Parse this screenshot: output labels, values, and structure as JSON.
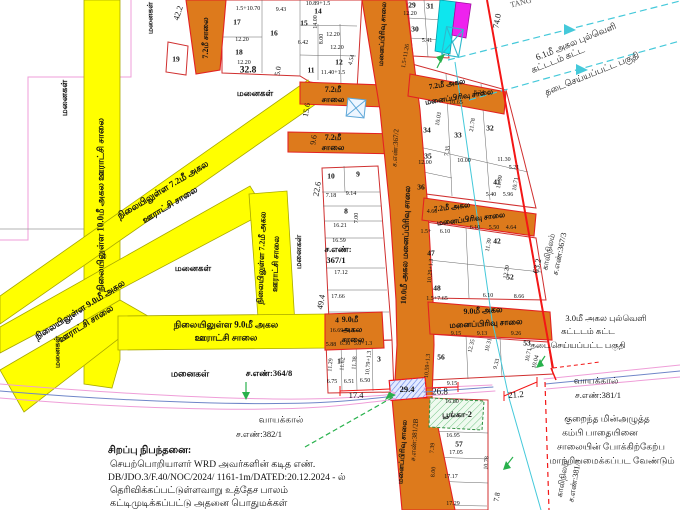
{
  "special_note": {
    "heading": "சிறப்பு நிபந்தனை:",
    "lines": [
      "செயற்பொறியாளர் WRD அவர்களின் கடித எண்.",
      "DB/JDO.3/F.40/NOC/2024/ 1161-1m/DATED:20.12.2024 - ல்",
      "தெரிவிக்கப்பட்டுள்ளவாறு உத்தேச பாலம்",
      "கட்டிமுடிக்கப்பட்டு அதனை பொதுமக்கள்"
    ]
  },
  "colors": {
    "road_yellow": "#ffff00",
    "road_orange": "#dd7a1c",
    "boundary_red": "#f31616",
    "parcel_pink": "#ef9ed8",
    "stream_blue": "#6f86c8",
    "powerline_cyan": "#45c9da",
    "marker_green": "#28b14c",
    "park_green": "#3fae5a",
    "block_magenta": "#ee22ee",
    "block_cyan": "#0ee6ee"
  },
  "map": {
    "road_labels": [
      {
        "t": "நிலையிலுள்ள 10.0மீ அகல ஊராட்சி சாலை",
        "x": 101,
        "y": 205,
        "r": -90,
        "s": 9
      },
      {
        "t": "நிலையிலுள்ள 7.2மீ அகல",
        "x": 262,
        "y": 258,
        "r": -88
      },
      {
        "t": "ஊராட்சி சாலை",
        "x": 276,
        "y": 264,
        "r": -88
      },
      {
        "t": "நிலையிலுள்ள 7.2மீ அகல",
        "x": 163,
        "y": 190,
        "r": -31,
        "s": 9
      },
      {
        "t": "ஊராட்சி சாலை",
        "x": 170,
        "y": 205,
        "r": -31,
        "s": 9
      },
      {
        "t": "நிலையிலுள்ள 9.0மீ அகல",
        "x": 80,
        "y": 310,
        "r": -32,
        "s": 9
      },
      {
        "t": "ஊராட்சி சாலை",
        "x": 86,
        "y": 324,
        "r": -32,
        "s": 9
      },
      {
        "t": "நிலையிலுள்ள 9.0மீ அகல",
        "x": 226,
        "y": 325,
        "s": 9
      },
      {
        "t": "ஊராட்சி சாலை",
        "x": 226,
        "y": 338,
        "s": 9
      },
      {
        "t": "7.2மீ சாலை",
        "x": 206,
        "y": 38,
        "r": -90
      },
      {
        "t": "7.2மீ",
        "x": 333,
        "y": 90
      },
      {
        "t": "சாலை",
        "x": 333,
        "y": 100
      },
      {
        "t": "7.2மீ",
        "x": 333,
        "y": 138
      },
      {
        "t": "சாலை",
        "x": 333,
        "y": 148
      },
      {
        "t": "மனைப்பிரிவு சாலை",
        "x": 383,
        "y": 34,
        "r": -87,
        "s": 7
      },
      {
        "t": "ச.எண்:367/2",
        "x": 396,
        "y": 148,
        "r": -87,
        "s": 7,
        "w": 400
      },
      {
        "t": "10.0மீ அகல மனைப்பிரிவு சாலை",
        "x": 406,
        "y": 245,
        "r": -88
      },
      {
        "t": "9.0மீ",
        "x": 350,
        "y": 320
      },
      {
        "t": "அகல",
        "x": 352,
        "y": 330
      },
      {
        "t": "சாலை",
        "x": 353,
        "y": 340
      },
      {
        "t": "7.2மீ அகல",
        "x": 447,
        "y": 84,
        "r": -9,
        "s": 7.5
      },
      {
        "t": "மனைப்பிரிவு சாலை",
        "x": 459,
        "y": 97,
        "r": -9,
        "s": 7.5
      },
      {
        "t": "7.2மீ அகல",
        "x": 452,
        "y": 207,
        "r": -7,
        "s": 7.5
      },
      {
        "t": "மனைப்பிரிவு சாலை",
        "x": 471,
        "y": 219,
        "r": -7,
        "s": 7.5
      },
      {
        "t": "9.0மீ அகல",
        "x": 483,
        "y": 311,
        "r": -3
      },
      {
        "t": "மனைப்பிரிவு சாலை",
        "x": 486,
        "y": 324,
        "r": -3
      },
      {
        "t": "மனைப்பிரிவு சாலை",
        "x": 403,
        "y": 452,
        "r": -86,
        "s": 7
      },
      {
        "t": "ச.எண்:381/2B",
        "x": 415,
        "y": 440,
        "r": -86,
        "s": 7,
        "w": 400
      }
    ],
    "area_labels": [
      {
        "t": "மனைகள்",
        "x": 64,
        "y": 98,
        "r": -90
      },
      {
        "t": "மனைகள்",
        "x": 150,
        "y": 18,
        "r": -90,
        "s": 7.5
      },
      {
        "t": "மனைகள்",
        "x": 255,
        "y": 93
      },
      {
        "t": "மனைகள்",
        "x": 193,
        "y": 268
      },
      {
        "t": "மனைகள்",
        "x": 299,
        "y": 252,
        "r": -90,
        "s": 8
      },
      {
        "t": "மனைகள்",
        "x": 190,
        "y": 374,
        "s": 9
      },
      {
        "t": "மனைகள்",
        "x": 57,
        "y": 352,
        "r": -90,
        "s": 7.5
      }
    ],
    "survey_labels": [
      {
        "t": "ச.எண்:364/8",
        "x": 269,
        "y": 373,
        "w": 700
      },
      {
        "t": "ச.எண்:",
        "x": 338,
        "y": 249,
        "w": 700
      },
      {
        "t": "367/1",
        "x": 336,
        "y": 260,
        "w": 700
      },
      {
        "t": "காலிநிலம்",
        "x": 549,
        "y": 252,
        "r": -78,
        "s": 8
      },
      {
        "t": "ச.எண்:367/3",
        "x": 560,
        "y": 254,
        "r": -78,
        "s": 8
      },
      {
        "t": "காலிநிலம்",
        "x": 563,
        "y": 479,
        "r": -80,
        "s": 8
      },
      {
        "t": "ச.எண்:381/3",
        "x": 575,
        "y": 481,
        "r": -80,
        "s": 8
      },
      {
        "t": "வாயக்கால்",
        "x": 281,
        "y": 420,
        "s": 9
      },
      {
        "t": "ச.எண்:382/1",
        "x": 259,
        "y": 434
      },
      {
        "t": "வாயக்கால்",
        "x": 596,
        "y": 381,
        "s": 9
      },
      {
        "t": "ச.எண்:381/1",
        "x": 598,
        "y": 395
      },
      {
        "t": "பூங்கா-2",
        "x": 457,
        "y": 415,
        "s": 8,
        "w": 700
      }
    ],
    "annotations": [
      {
        "t": "6.1மீ அகல புல்வெளி",
        "x": 576,
        "y": 42,
        "r": -22
      },
      {
        "t": "கட்டடம் கட்ட",
        "x": 558,
        "y": 60,
        "r": -22
      },
      {
        "t": "தடைசெய்யப்பட்ட பகுதி",
        "x": 592,
        "y": 74,
        "r": -22
      },
      {
        "t": "3.0மீ அகல புல்வெளி",
        "x": 606,
        "y": 318,
        "s": 8.5
      },
      {
        "t": "கட்டடம் கட்ட",
        "x": 588,
        "y": 331,
        "s": 8.5
      },
      {
        "t": "தடைசெய்யப்பட்ட பகுதி",
        "x": 578,
        "y": 345,
        "s": 8.5
      },
      {
        "t": "குறைந்த மின்அழுத்த",
        "x": 607,
        "y": 419
      },
      {
        "t": "கம்பி பாதையினை",
        "x": 600,
        "y": 433
      },
      {
        "t": "சாலையின் போக்கிற்கேற்ப",
        "x": 611,
        "y": 447
      },
      {
        "t": "மாற்றியமைக்கப்பட வேண்டும்",
        "x": 612,
        "y": 461
      },
      {
        "t": "TANG",
        "x": 521,
        "y": 3,
        "r": -14,
        "s": 8,
        "c": "#555"
      }
    ],
    "dimensions_major": [
      {
        "t": "42.2",
        "x": 178,
        "y": 13,
        "r": -72
      },
      {
        "t": "74.0",
        "x": 497,
        "y": 21,
        "r": -80
      },
      {
        "t": "32.8",
        "x": 248,
        "y": 71,
        "s": 9.5,
        "w": 700
      },
      {
        "t": "5.0",
        "x": 278,
        "y": 71,
        "r": -80,
        "s": 7.5
      },
      {
        "t": "15.6",
        "x": 307,
        "y": 110,
        "r": -80,
        "s": 8
      },
      {
        "t": "9.6",
        "x": 314,
        "y": 140,
        "r": -80,
        "s": 8
      },
      {
        "t": "22.6",
        "x": 317,
        "y": 189,
        "r": -80
      },
      {
        "t": "49.4",
        "x": 321,
        "y": 302,
        "r": -80
      },
      {
        "t": "63.2",
        "x": 537,
        "y": 266,
        "r": -78
      },
      {
        "t": "17.4",
        "x": 356,
        "y": 395
      },
      {
        "t": "29.4",
        "x": 407,
        "y": 389,
        "w": 700
      },
      {
        "t": "26.8",
        "x": 440,
        "y": 392,
        "s": 9
      },
      {
        "t": "21.2",
        "x": 516,
        "y": 395,
        "r": -4,
        "s": 9
      },
      {
        "t": "7.8",
        "x": 497,
        "y": 497,
        "r": -80,
        "s": 7.5
      }
    ],
    "plot_numbers": [
      {
        "t": "19",
        "x": 176,
        "y": 59
      },
      {
        "t": "17",
        "x": 237,
        "y": 22
      },
      {
        "t": "18",
        "x": 239,
        "y": 52
      },
      {
        "t": "16",
        "x": 274,
        "y": 33
      },
      {
        "t": "15",
        "x": 304,
        "y": 23
      },
      {
        "t": "14",
        "x": 318,
        "y": 11
      },
      {
        "t": "12",
        "x": 339,
        "y": 62
      },
      {
        "t": "11",
        "x": 311,
        "y": 70
      },
      {
        "t": "10",
        "x": 331,
        "y": 176
      },
      {
        "t": "9",
        "x": 358,
        "y": 174
      },
      {
        "t": "8",
        "x": 346,
        "y": 211
      },
      {
        "t": "4",
        "x": 337,
        "y": 320
      },
      {
        "t": "1",
        "x": 339,
        "y": 361
      },
      {
        "t": "3",
        "x": 379,
        "y": 359
      },
      {
        "t": "29",
        "x": 412,
        "y": 5
      },
      {
        "t": "30",
        "x": 415,
        "y": 29
      },
      {
        "t": "31",
        "x": 430,
        "y": 6
      },
      {
        "t": "34",
        "x": 427,
        "y": 130
      },
      {
        "t": "33",
        "x": 458,
        "y": 135
      },
      {
        "t": "32",
        "x": 490,
        "y": 128
      },
      {
        "t": "35",
        "x": 428,
        "y": 156
      },
      {
        "t": "36",
        "x": 421,
        "y": 187
      },
      {
        "t": "41",
        "x": 497,
        "y": 182
      },
      {
        "t": "42",
        "x": 497,
        "y": 241
      },
      {
        "t": "47",
        "x": 431,
        "y": 253
      },
      {
        "t": "48",
        "x": 437,
        "y": 288
      },
      {
        "t": "52",
        "x": 510,
        "y": 277
      },
      {
        "t": "53",
        "x": 527,
        "y": 343
      },
      {
        "t": "56",
        "x": 441,
        "y": 357
      },
      {
        "t": "57",
        "x": 459,
        "y": 444
      }
    ],
    "dimensions": [
      {
        "t": "1.5+10.70",
        "x": 248,
        "y": 9
      },
      {
        "t": "9.43",
        "x": 281,
        "y": 10
      },
      {
        "t": "12.20",
        "x": 242,
        "y": 40
      },
      {
        "t": "12.20",
        "x": 244,
        "y": 63
      },
      {
        "t": "10.89+1.5",
        "x": 318,
        "y": 4
      },
      {
        "t": "14.00",
        "x": 316,
        "y": 22,
        "r": -90
      },
      {
        "t": "12.20",
        "x": 333,
        "y": 35
      },
      {
        "t": "12.20",
        "x": 337,
        "y": 48
      },
      {
        "t": "6.42",
        "x": 303,
        "y": 43
      },
      {
        "t": "8.00",
        "x": 322,
        "y": 39,
        "r": -90
      },
      {
        "t": "11.40+1.5",
        "x": 333,
        "y": 73
      },
      {
        "t": "4.54",
        "x": 352,
        "y": 60,
        "r": -75
      },
      {
        "t": "12.20",
        "x": 410,
        "y": 14
      },
      {
        "t": "1.5+11.26",
        "x": 406,
        "y": 56,
        "r": -80
      },
      {
        "t": "5.41",
        "x": 427,
        "y": 41
      },
      {
        "t": "7.18",
        "x": 331,
        "y": 196
      },
      {
        "t": "9.14",
        "x": 351,
        "y": 194
      },
      {
        "t": "16.21",
        "x": 340,
        "y": 226
      },
      {
        "t": "16.59",
        "x": 339,
        "y": 241
      },
      {
        "t": "17.12",
        "x": 341,
        "y": 273
      },
      {
        "t": "17.66",
        "x": 338,
        "y": 297
      },
      {
        "t": "16.69+1.3",
        "x": 342,
        "y": 331
      },
      {
        "t": "7.00",
        "x": 357,
        "y": 218,
        "r": -90
      },
      {
        "t": "5.88",
        "x": 331,
        "y": 345
      },
      {
        "t": "6.30",
        "x": 345,
        "y": 344
      },
      {
        "t": "5.0+1.3",
        "x": 363,
        "y": 344
      },
      {
        "t": "11.29",
        "x": 331,
        "y": 365,
        "r": -85
      },
      {
        "t": "11.62",
        "x": 343,
        "y": 364,
        "r": -85
      },
      {
        "t": "11.38",
        "x": 355,
        "y": 363,
        "r": -85
      },
      {
        "t": "10.79+1.3",
        "x": 369,
        "y": 363,
        "r": -85
      },
      {
        "t": "6.75",
        "x": 332,
        "y": 382
      },
      {
        "t": "6.51",
        "x": 349,
        "y": 382
      },
      {
        "t": "6.50",
        "x": 365,
        "y": 381
      },
      {
        "t": "10.65",
        "x": 456,
        "y": 103
      },
      {
        "t": "8.24",
        "x": 479,
        "y": 93
      },
      {
        "t": "21.78",
        "x": 473,
        "y": 125,
        "r": -80
      },
      {
        "t": "10.03",
        "x": 439,
        "y": 119,
        "r": -80
      },
      {
        "t": "7.35",
        "x": 448,
        "y": 151,
        "r": -80
      },
      {
        "t": "12.00",
        "x": 425,
        "y": 163
      },
      {
        "t": "10.00",
        "x": 464,
        "y": 161
      },
      {
        "t": "11.30",
        "x": 504,
        "y": 160
      },
      {
        "t": "5.21",
        "x": 514,
        "y": 168
      },
      {
        "t": "11.30",
        "x": 500,
        "y": 182,
        "r": -80
      },
      {
        "t": "10.71",
        "x": 516,
        "y": 184,
        "r": -80
      },
      {
        "t": "5.40",
        "x": 491,
        "y": 195
      },
      {
        "t": "5.96",
        "x": 508,
        "y": 195
      },
      {
        "t": "6.10",
        "x": 475,
        "y": 228
      },
      {
        "t": "5.50",
        "x": 494,
        "y": 228
      },
      {
        "t": "4.64",
        "x": 511,
        "y": 228
      },
      {
        "t": "1.5+",
        "x": 426,
        "y": 232
      },
      {
        "t": "6.10",
        "x": 445,
        "y": 232
      },
      {
        "t": "4.60",
        "x": 432,
        "y": 212
      },
      {
        "t": "10.29+1.3",
        "x": 431,
        "y": 271,
        "r": -85
      },
      {
        "t": "11.30",
        "x": 489,
        "y": 245,
        "r": -80
      },
      {
        "t": "12.20",
        "x": 507,
        "y": 272,
        "r": -80
      },
      {
        "t": "6.10",
        "x": 488,
        "y": 296
      },
      {
        "t": "8.66",
        "x": 519,
        "y": 297
      },
      {
        "t": "1.5+7.65",
        "x": 437,
        "y": 299
      },
      {
        "t": "9.15",
        "x": 456,
        "y": 334
      },
      {
        "t": "9.13",
        "x": 482,
        "y": 334
      },
      {
        "t": "9.26",
        "x": 516,
        "y": 334
      },
      {
        "t": "10.71",
        "x": 529,
        "y": 355,
        "r": -78
      },
      {
        "t": "10.04",
        "x": 536,
        "y": 362,
        "r": -75
      },
      {
        "t": "9.33",
        "x": 497,
        "y": 364,
        "r": -75
      },
      {
        "t": "12.35",
        "x": 472,
        "y": 346,
        "r": -75
      },
      {
        "t": "10.31",
        "x": 489,
        "y": 345,
        "r": -75
      },
      {
        "t": "10.59+1.3",
        "x": 428,
        "y": 366,
        "r": -85
      },
      {
        "t": "9.15",
        "x": 452,
        "y": 384
      },
      {
        "t": "16.80",
        "x": 452,
        "y": 402
      },
      {
        "t": "16.95",
        "x": 453,
        "y": 436
      },
      {
        "t": "17.05",
        "x": 456,
        "y": 453
      },
      {
        "t": "17.17",
        "x": 451,
        "y": 477
      },
      {
        "t": "17.29",
        "x": 453,
        "y": 504
      },
      {
        "t": "10.78",
        "x": 487,
        "y": 463,
        "r": -85
      },
      {
        "t": "7.39",
        "x": 433,
        "y": 448,
        "r": -85
      },
      {
        "t": "8.00",
        "x": 434,
        "y": 472,
        "r": -85
      }
    ]
  }
}
